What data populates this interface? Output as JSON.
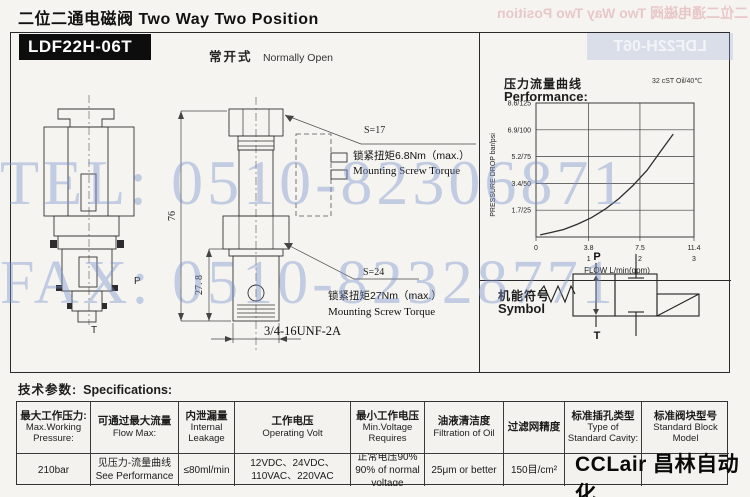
{
  "page": {
    "header": "二位二通电磁阀 Two Way Two Position",
    "model": "LDF22H-06T",
    "mode_zh": "常开式",
    "mode_en": "Normally Open"
  },
  "watermark": {
    "tel": "TEL: 0510-82306871",
    "fax": "FAX: 0510-82328771"
  },
  "drawing": {
    "dim_height": "76",
    "dim_cartridge": "27. 8",
    "port_p": "P",
    "port_t": "T",
    "s17": "S=17",
    "s24": "S=24",
    "torque1_zh": "锁紧扭矩6.8Nm（max.）",
    "torque1_en": "Mounting Screw Torque",
    "torque2_zh": "锁紧扭矩27Nm（max.）",
    "torque2_en": "Mounting Screw Torque",
    "thread": "3/4-16UNF-2A"
  },
  "performance": {
    "title_zh": "压力流量曲线",
    "title_en": "Performance:",
    "condition": "32 cST Oil/40℃"
  },
  "chart_data": {
    "type": "line",
    "title": "压力流量曲线 Performance",
    "xlabel": "FLOW L/min(gpm)",
    "ylabel": "PRESSURE DROP bar/psi",
    "xlim": [
      0,
      11.4
    ],
    "ylim": [
      0,
      125
    ],
    "grid": true,
    "x_ticks": [
      {
        "flow": 0,
        "label": "0",
        "gpm": ""
      },
      {
        "flow": 3.8,
        "label": "3.8",
        "gpm": "1"
      },
      {
        "flow": 7.5,
        "label": "7.5",
        "gpm": "2"
      },
      {
        "flow": 11.4,
        "label": "11.4",
        "gpm": "3"
      }
    ],
    "x_grid": [
      3.8,
      7.5
    ],
    "y_ticks": [
      {
        "psi": 125,
        "label": "8.6/125"
      },
      {
        "psi": 100,
        "label": "6.9/100"
      },
      {
        "psi": 75,
        "label": "5.2/75"
      },
      {
        "psi": 50,
        "label": "3.4/50"
      },
      {
        "psi": 25,
        "label": "1.7/25"
      }
    ],
    "series": [
      {
        "name": "pressure drop vs flow",
        "flow": [
          0.3,
          1,
          2,
          3,
          4,
          5,
          6,
          7,
          8,
          9,
          9.9
        ],
        "psi": [
          2,
          4,
          7,
          12,
          18,
          26,
          36,
          48,
          62,
          80,
          96
        ]
      }
    ]
  },
  "symbol": {
    "title_zh": "机能符号",
    "title_en": "Symbol",
    "port_p": "P",
    "port_t": "T"
  },
  "specs": {
    "title_zh": "技术参数:",
    "title_en": "Specifications:",
    "columns": [
      {
        "zh": "最大工作压力:",
        "en": "Max.Working Pressure:",
        "v1": "210bar",
        "v2": ""
      },
      {
        "zh": "可通过最大流量",
        "en": "Flow Max:",
        "v1": "见压力-流量曲线",
        "v2": "See Performance"
      },
      {
        "zh": "内泄漏量",
        "en": "Internal Leakage",
        "v1": "≤80ml/min",
        "v2": ""
      },
      {
        "zh": "工作电压",
        "en": "Operating Volt",
        "v1": "12VDC、24VDC、",
        "v2": "110VAC、220VAC"
      },
      {
        "zh": "最小工作电压",
        "en": "Min.Voltage Requires",
        "v1": "正常电压90%",
        "v2": "90% of normal voltage"
      },
      {
        "zh": "油液清洁度",
        "en": "Filtration of Oil",
        "v1": "25μm or better",
        "v2": ""
      },
      {
        "zh": "过滤网精度",
        "en": "",
        "v1": "150目/cm²",
        "v2": ""
      },
      {
        "zh": "标准插孔类型",
        "en": "Type of Standard Cavity:",
        "v1": "",
        "v2": ""
      },
      {
        "zh": "标准阀块型号",
        "en": "Standard Block Model",
        "v1": "",
        "v2": ""
      }
    ]
  },
  "logo": "CCLair 昌林自动化"
}
